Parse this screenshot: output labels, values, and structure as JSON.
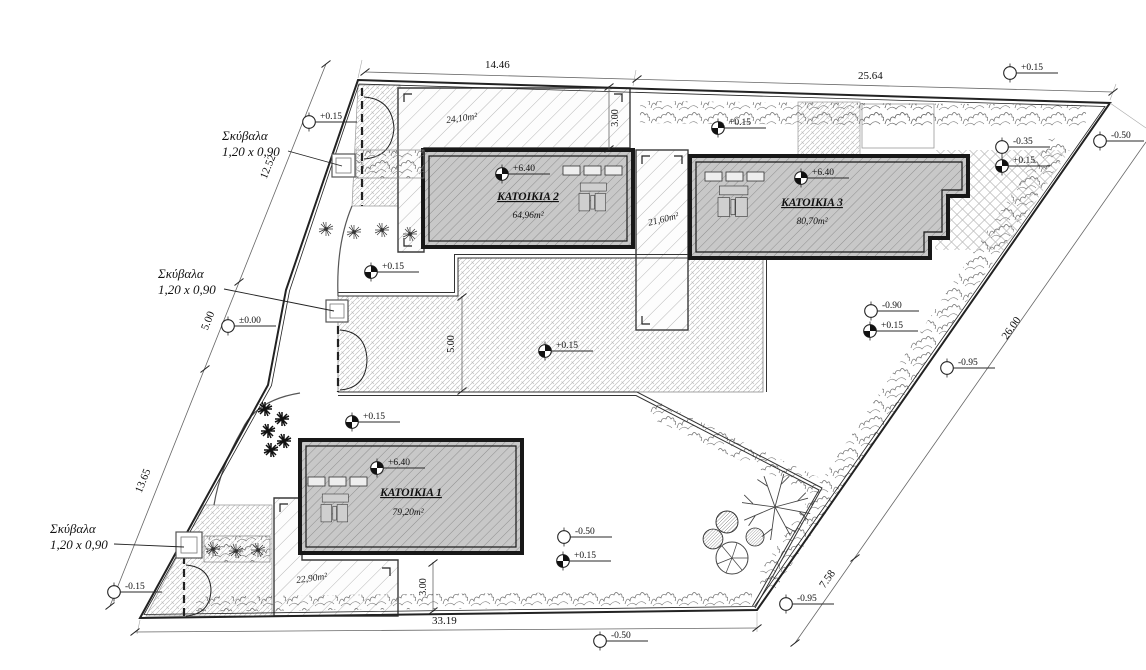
{
  "buildings": [
    {
      "name": "ΚΑΤΟΙΚΙΑ 1",
      "area": "79,20m²",
      "elevation": "+6.40"
    },
    {
      "name": "ΚΑΤΟΙΚΙΑ 2",
      "area": "64,96m²",
      "elevation": "+6.40"
    },
    {
      "name": "ΚΑΤΟΙΚΙΑ 3",
      "area": "80,70m²",
      "elevation": "+6.40"
    }
  ],
  "yards": [
    {
      "label": "24,10m²"
    },
    {
      "label": "21,60m²"
    },
    {
      "label": "22,90m²"
    }
  ],
  "bins": [
    {
      "title": "Σκύβαλα",
      "size": "1,20 x 0,90"
    },
    {
      "title": "Σκύβαλα",
      "size": "1,20 x 0,90"
    },
    {
      "title": "Σκύβαλα",
      "size": "1,20 x 0,90"
    }
  ],
  "dims": {
    "top_left": "14.46",
    "top_right": "25.64",
    "left_upper": "12.52",
    "left_mid": "5.00",
    "left_lower": "13.65",
    "bottom": "33.19",
    "right_upper": "26.00",
    "right_lower": "7.58",
    "offset_top": "3.00",
    "driveway": "5.00",
    "offset_bottom": "3.00"
  },
  "levels": [
    {
      "value": "+0.15"
    },
    {
      "value": "+0.15"
    },
    {
      "value": "-0.50"
    },
    {
      "value": "-0.35"
    },
    {
      "value": "+0.15"
    },
    {
      "value": "+0.15"
    },
    {
      "value": "-0.90"
    },
    {
      "value": "+0.15"
    },
    {
      "value": "-0.95"
    },
    {
      "value": "+0.15"
    },
    {
      "value": "±0.00"
    },
    {
      "value": "+0.15"
    },
    {
      "value": "+0.15"
    },
    {
      "value": "-0.50"
    },
    {
      "value": "+0.15"
    },
    {
      "value": "-0.15"
    },
    {
      "value": "-0.50"
    },
    {
      "value": "-0.95"
    }
  ]
}
